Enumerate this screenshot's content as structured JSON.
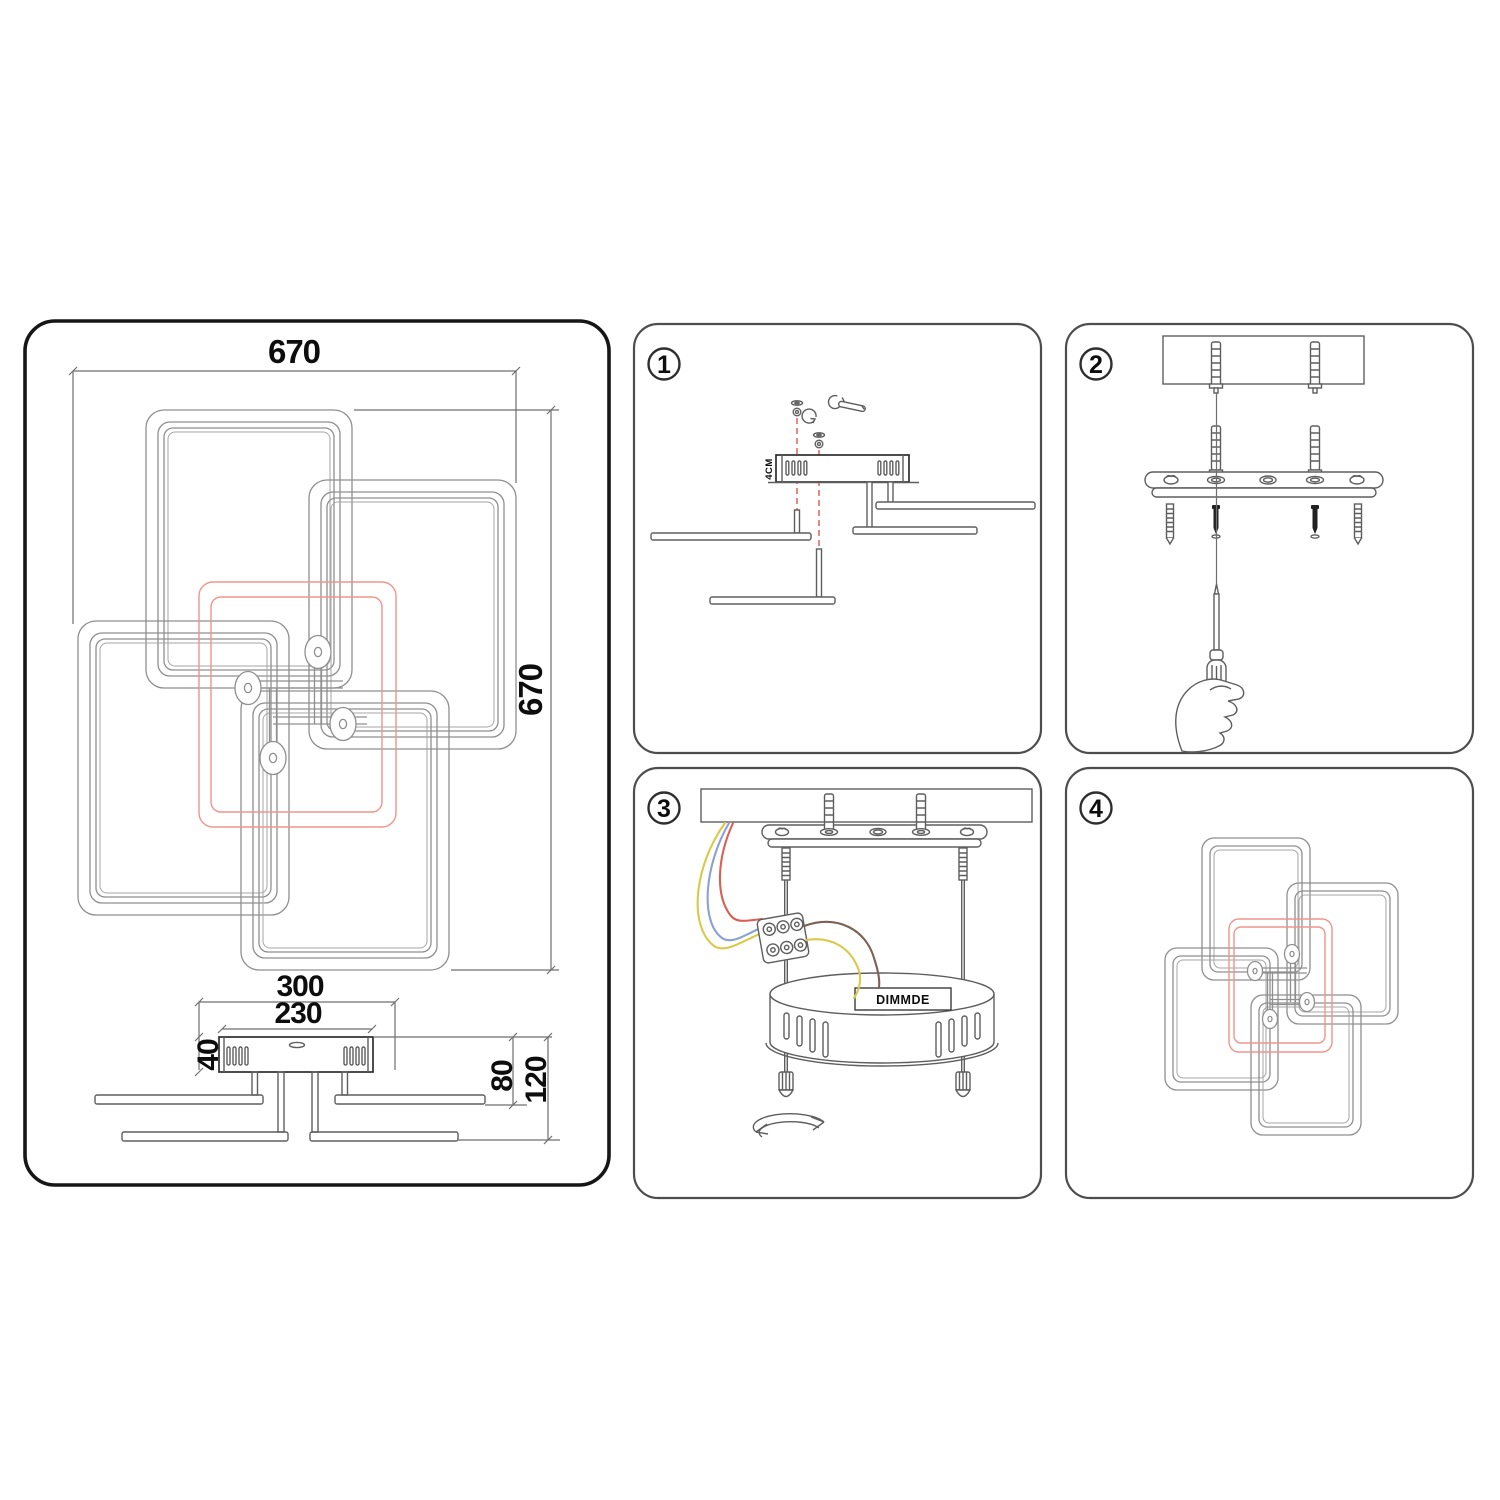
{
  "sheet": {
    "background": "#ffffff"
  },
  "main_panel": {
    "dims": {
      "width_top": "670",
      "height_right": "670",
      "plate_width": "300",
      "canopy_width": "230",
      "canopy_height": "40",
      "drop_upper": "80",
      "drop_lower": "120"
    }
  },
  "steps": [
    {
      "number": "1",
      "note": "4CM"
    },
    {
      "number": "2"
    },
    {
      "number": "3",
      "driver_label": "DIMMDE"
    },
    {
      "number": "4"
    }
  ],
  "colors": {
    "accent_red_frame": "#f0958b",
    "accent_red_dash": "#e4756b",
    "wire_yellow": "#d9c94b",
    "wire_blue": "#8ba1d4",
    "wire_red": "#d95f53",
    "wire_brown": "#7d6152",
    "line_gray": "#8f8f8f",
    "line_dark": "#2e2e2e"
  }
}
